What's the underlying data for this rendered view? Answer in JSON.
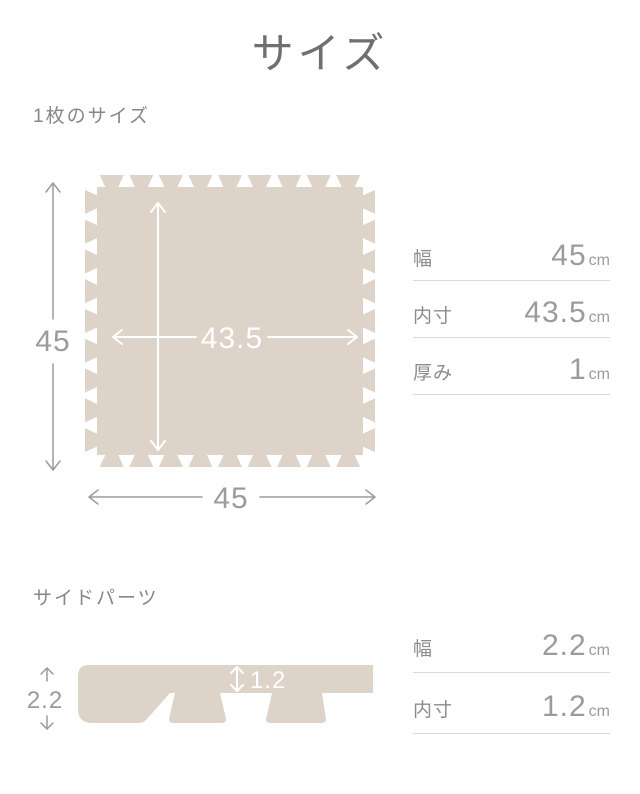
{
  "page": {
    "title": "サイズ"
  },
  "colors": {
    "mat": "#ded3c8",
    "title_text": "#6f6f6f",
    "heading_text": "#878787",
    "label_text": "#8c8c8c",
    "value_text": "#9b9b9b",
    "dimension": "#9b9b9b",
    "divider": "#d9d9d9",
    "arrow_white": "#ffffff"
  },
  "section_one": {
    "heading": "1枚のサイズ",
    "figure": {
      "outer_height": "45",
      "outer_width": "45",
      "inner_size": "43.5"
    },
    "table": {
      "rows": [
        {
          "label": "幅",
          "value": "45",
          "unit": "cm"
        },
        {
          "label": "内寸",
          "value": "43.5",
          "unit": "cm"
        },
        {
          "label": "厚み",
          "value": "1",
          "unit": "cm"
        }
      ]
    }
  },
  "section_two": {
    "heading": "サイドパーツ",
    "figure": {
      "outer_height": "2.2",
      "inner_height": "1.2"
    },
    "table": {
      "rows": [
        {
          "label": "幅",
          "value": "2.2",
          "unit": "cm"
        },
        {
          "label": "内寸",
          "value": "1.2",
          "unit": "cm"
        }
      ]
    }
  }
}
